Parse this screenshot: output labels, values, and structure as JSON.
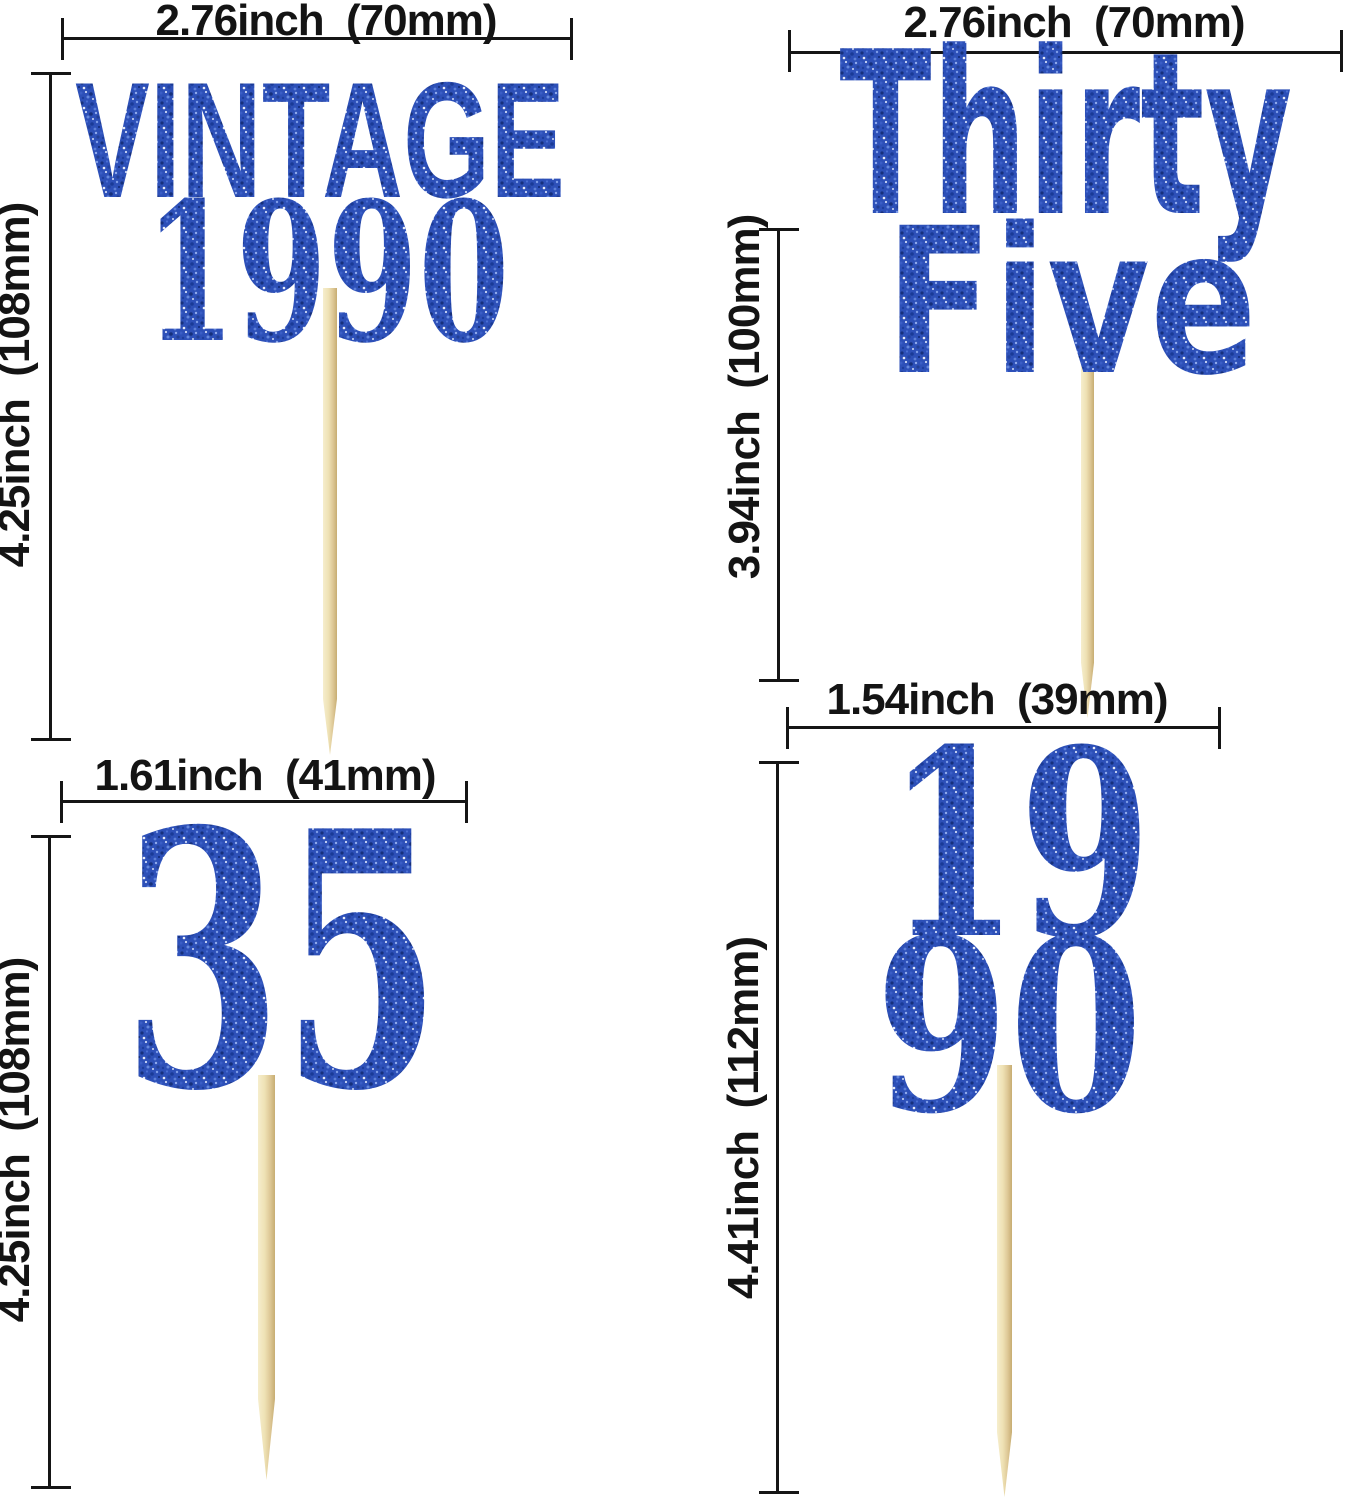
{
  "product_colors": {
    "glitter_blue": "#2d50b8",
    "glitter_dark_speck": "#16307c",
    "glitter_light_speck": "#8fa9ec",
    "sparkle_white": "#ffffff",
    "stick_wood": "#eee1b4",
    "dimension_ink": "#151515"
  },
  "toppers": {
    "vintage_1990": {
      "width_label": "2.76inch  (70mm)",
      "height_label": "4.25inch  (108mm)",
      "line1": "VINTAGE",
      "line2": "1990"
    },
    "thirty_five": {
      "width_label": "2.76inch  (70mm)",
      "height_label": "3.94inch  (100mm)",
      "line1": "Thirty",
      "line2": "Five"
    },
    "numeral_35": {
      "width_label": "1.61inch  (41mm)",
      "height_label": "4.25inch  (108mm)",
      "line1": "35"
    },
    "numerals_1990_stacked": {
      "width_label": "1.54inch  (39mm)",
      "height_label": "4.41inch  (112mm)",
      "line1": "19",
      "line2": "90"
    }
  }
}
